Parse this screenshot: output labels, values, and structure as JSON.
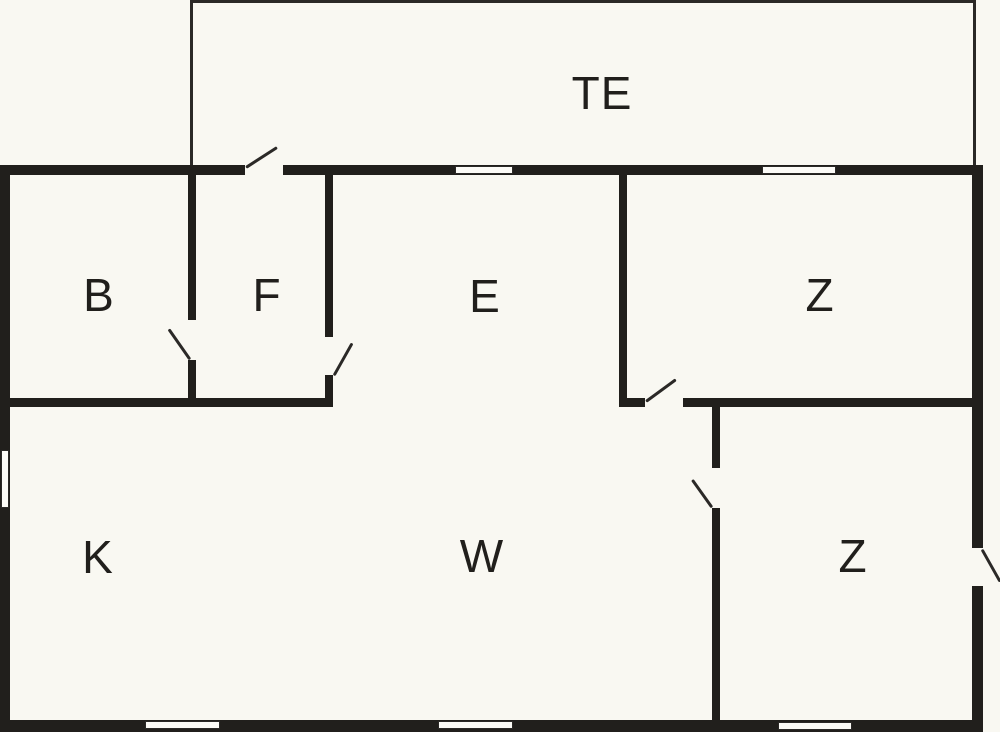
{
  "canvas": {
    "width": 1000,
    "height": 732,
    "background": "#f9f8f2"
  },
  "colors": {
    "wall": "#211f1c",
    "thin_line": "#2b2927",
    "window_fill": "#fcfbf7",
    "label": "#211f1c"
  },
  "rooms": [
    {
      "name": "room-label-te",
      "label": "TE",
      "cx": 602,
      "cy": 93
    },
    {
      "name": "room-label-b",
      "label": "B",
      "cx": 99,
      "cy": 295
    },
    {
      "name": "room-label-f",
      "label": "F",
      "cx": 267,
      "cy": 295
    },
    {
      "name": "room-label-e",
      "label": "E",
      "cx": 485,
      "cy": 296
    },
    {
      "name": "room-label-z-top",
      "label": "Z",
      "cx": 820,
      "cy": 295
    },
    {
      "name": "room-label-k",
      "label": "K",
      "cx": 98,
      "cy": 557
    },
    {
      "name": "room-label-w",
      "label": "W",
      "cx": 482,
      "cy": 556
    },
    {
      "name": "room-label-z-bottom",
      "label": "Z",
      "cx": 853,
      "cy": 556
    }
  ],
  "walls": [
    {
      "name": "top-wall-left-of-terrace-door",
      "x": 0,
      "y": 165,
      "w": 245,
      "h": 10
    },
    {
      "name": "top-wall-right-of-terrace-door",
      "x": 283,
      "y": 165,
      "w": 699,
      "h": 10
    },
    {
      "name": "left-exterior-wall",
      "x": 0,
      "y": 165,
      "w": 10,
      "h": 567
    },
    {
      "name": "bottom-exterior-wall",
      "x": 0,
      "y": 720,
      "w": 983,
      "h": 12
    },
    {
      "name": "right-exterior-wall-upper",
      "x": 972,
      "y": 165,
      "w": 11,
      "h": 383
    },
    {
      "name": "right-exterior-wall-lower",
      "x": 972,
      "y": 586,
      "w": 11,
      "h": 146
    },
    {
      "name": "b-f-divider-upper",
      "x": 188,
      "y": 175,
      "w": 8,
      "h": 145
    },
    {
      "name": "b-f-divider-stub",
      "x": 188,
      "y": 360,
      "w": 8,
      "h": 38
    },
    {
      "name": "f-e-divider-upper",
      "x": 325,
      "y": 175,
      "w": 8,
      "h": 162
    },
    {
      "name": "f-e-divider-stub",
      "x": 325,
      "y": 375,
      "w": 8,
      "h": 23
    },
    {
      "name": "b-f-bottom-wall",
      "x": 10,
      "y": 398,
      "w": 323,
      "h": 9
    },
    {
      "name": "e-z-divider",
      "x": 619,
      "y": 175,
      "w": 8,
      "h": 232
    },
    {
      "name": "z-top-bottom-wall-stub",
      "x": 619,
      "y": 398,
      "w": 26,
      "h": 9
    },
    {
      "name": "z-top-bottom-wall",
      "x": 683,
      "y": 398,
      "w": 289,
      "h": 9
    },
    {
      "name": "w-z-divider-upper",
      "x": 712,
      "y": 407,
      "w": 8,
      "h": 61
    },
    {
      "name": "w-z-divider-lower",
      "x": 712,
      "y": 508,
      "w": 8,
      "h": 212
    }
  ],
  "terrace_walls": [
    {
      "name": "terrace-top-edge",
      "x": 190,
      "y": 0,
      "w": 786,
      "h": 3
    },
    {
      "name": "terrace-left-edge",
      "x": 190,
      "y": 0,
      "w": 3,
      "h": 165
    },
    {
      "name": "terrace-right-edge",
      "x": 973,
      "y": 0,
      "w": 3,
      "h": 165
    }
  ],
  "windows": [
    {
      "name": "window-top-1",
      "x": 455,
      "y": 166,
      "w": 58,
      "h": 8
    },
    {
      "name": "window-top-2",
      "x": 762,
      "y": 166,
      "w": 74,
      "h": 8
    },
    {
      "name": "window-left",
      "x": 1,
      "y": 450,
      "w": 8,
      "h": 58
    },
    {
      "name": "window-bottom-1",
      "x": 145,
      "y": 721,
      "w": 75,
      "h": 8
    },
    {
      "name": "window-bottom-2",
      "x": 438,
      "y": 721,
      "w": 75,
      "h": 8
    },
    {
      "name": "window-bottom-3",
      "x": 778,
      "y": 722,
      "w": 74,
      "h": 8
    }
  ],
  "door_swings": [
    {
      "name": "terrace-door-swing",
      "x1": 246,
      "y1": 167,
      "x2": 277,
      "y2": 147
    },
    {
      "name": "b-door-swing",
      "x1": 190,
      "y1": 359,
      "x2": 169,
      "y2": 329
    },
    {
      "name": "f-door-swing",
      "x1": 334,
      "y1": 375,
      "x2": 352,
      "y2": 343
    },
    {
      "name": "z-top-door-swing",
      "x1": 646,
      "y1": 401,
      "x2": 676,
      "y2": 379
    },
    {
      "name": "z-bottom-door-swing",
      "x1": 712,
      "y1": 507,
      "x2": 692,
      "y2": 479
    },
    {
      "name": "exterior-door-swing",
      "x1": 982,
      "y1": 549,
      "x2": 1000,
      "y2": 581
    }
  ]
}
